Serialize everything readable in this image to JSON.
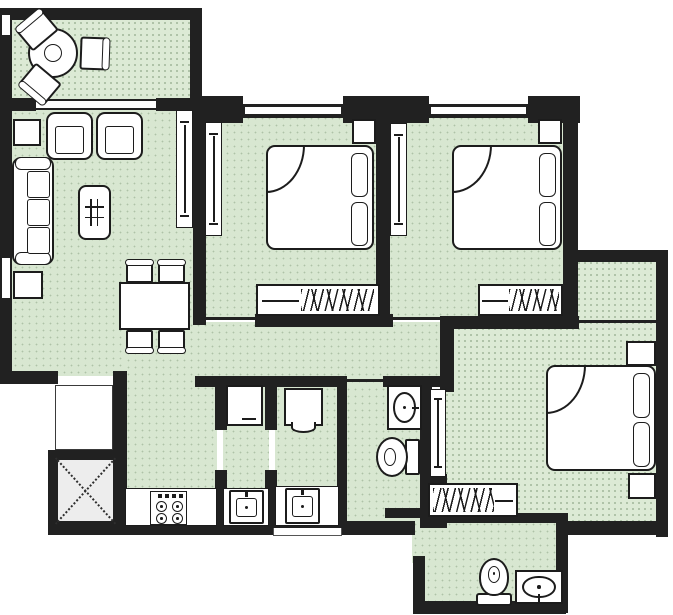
{
  "meta": {
    "canvas": {
      "w": 673,
      "h": 615
    }
  },
  "palette": {
    "wall": "#212121",
    "floor_green": "#d8e7d1",
    "balcony_green": "#dcead5",
    "shaft_gray": "#ededed",
    "furniture_fill": "#ffffff",
    "furniture_stroke": "#1c1c1c"
  },
  "rooms": [
    {
      "name": "balcony-floor",
      "kind": "dotted",
      "x": 12,
      "y": 20,
      "w": 178,
      "h": 80
    },
    {
      "name": "living-dining-floor",
      "kind": "plain",
      "x": 12,
      "y": 110,
      "w": 181,
      "h": 266
    },
    {
      "name": "hallway-floor",
      "kind": "plain",
      "x": 125,
      "y": 322,
      "w": 318,
      "h": 64
    },
    {
      "name": "kitchen-floor",
      "kind": "plain",
      "x": 125,
      "y": 378,
      "w": 92,
      "h": 148
    },
    {
      "name": "utility-a-floor",
      "kind": "plain",
      "x": 223,
      "y": 386,
      "w": 46,
      "h": 140
    },
    {
      "name": "utility-b-floor",
      "kind": "plain",
      "x": 275,
      "y": 386,
      "w": 64,
      "h": 140
    },
    {
      "name": "corridor-floor",
      "kind": "plain",
      "x": 345,
      "y": 386,
      "w": 87,
      "h": 146
    },
    {
      "name": "common-bathroom-floor",
      "kind": "plain",
      "x": 385,
      "y": 386,
      "w": 47,
      "h": 128
    },
    {
      "name": "bedroom-1-floor",
      "kind": "plain",
      "x": 203,
      "y": 108,
      "w": 180,
      "h": 212
    },
    {
      "name": "bedroom-2-floor",
      "kind": "plain",
      "x": 388,
      "y": 108,
      "w": 182,
      "h": 212
    },
    {
      "name": "bedroom-3-floor",
      "kind": "dotted",
      "x": 444,
      "y": 326,
      "w": 216,
      "h": 200
    },
    {
      "name": "bedroom-3-ext-floor",
      "kind": "dotted",
      "x": 576,
      "y": 260,
      "w": 84,
      "h": 70
    },
    {
      "name": "attached-bathroom-floor",
      "kind": "plain",
      "x": 425,
      "y": 521,
      "w": 139,
      "h": 86
    },
    {
      "name": "bath-door-passage-floor",
      "kind": "plain",
      "x": 412,
      "y": 521,
      "w": 20,
      "h": 42
    },
    {
      "name": "shaft-floor",
      "kind": "shaft",
      "x": 56,
      "y": 458,
      "w": 60,
      "h": 66
    }
  ],
  "walls": [
    {
      "x": 2,
      "y": 8,
      "w": 200,
      "h": 12
    },
    {
      "x": 0,
      "y": 8,
      "w": 12,
      "h": 7
    },
    {
      "x": 0,
      "y": 35,
      "w": 12,
      "h": 75
    },
    {
      "x": 190,
      "y": 8,
      "w": 12,
      "h": 100
    },
    {
      "x": 12,
      "y": 98,
      "w": 24,
      "h": 13
    },
    {
      "x": 156,
      "y": 98,
      "w": 46,
      "h": 13
    },
    {
      "x": 0,
      "y": 110,
      "w": 12,
      "h": 148
    },
    {
      "x": 0,
      "y": 298,
      "w": 12,
      "h": 80
    },
    {
      "x": 0,
      "y": 371,
      "w": 58,
      "h": 13
    },
    {
      "x": 113,
      "y": 371,
      "w": 14,
      "h": 160
    },
    {
      "x": 48,
      "y": 450,
      "w": 68,
      "h": 10
    },
    {
      "x": 48,
      "y": 450,
      "w": 10,
      "h": 82
    },
    {
      "x": 48,
      "y": 521,
      "w": 225,
      "h": 14
    },
    {
      "x": 342,
      "y": 521,
      "w": 73,
      "h": 14
    },
    {
      "x": 273,
      "y": 521,
      "w": 69,
      "h": 7
    },
    {
      "x": 193,
      "y": 98,
      "w": 13,
      "h": 227
    },
    {
      "x": 195,
      "y": 104,
      "w": 385,
      "h": 14
    },
    {
      "x": 195,
      "y": 96,
      "w": 48,
      "h": 27
    },
    {
      "x": 343,
      "y": 96,
      "w": 86,
      "h": 27
    },
    {
      "x": 528,
      "y": 96,
      "w": 52,
      "h": 27
    },
    {
      "x": 376,
      "y": 98,
      "w": 14,
      "h": 220
    },
    {
      "x": 563,
      "y": 98,
      "w": 15,
      "h": 225
    },
    {
      "x": 565,
      "y": 258,
      "w": 13,
      "h": 66
    },
    {
      "x": 565,
      "y": 250,
      "w": 103,
      "h": 12
    },
    {
      "x": 656,
      "y": 250,
      "w": 12,
      "h": 287
    },
    {
      "x": 255,
      "y": 314,
      "w": 124,
      "h": 13
    },
    {
      "x": 376,
      "y": 314,
      "w": 17,
      "h": 13
    },
    {
      "x": 443,
      "y": 316,
      "w": 136,
      "h": 13
    },
    {
      "x": 440,
      "y": 316,
      "w": 14,
      "h": 76
    },
    {
      "x": 195,
      "y": 376,
      "w": 150,
      "h": 11
    },
    {
      "x": 383,
      "y": 376,
      "w": 60,
      "h": 11
    },
    {
      "x": 215,
      "y": 376,
      "w": 12,
      "h": 54
    },
    {
      "x": 215,
      "y": 470,
      "w": 12,
      "h": 58
    },
    {
      "x": 265,
      "y": 376,
      "w": 12,
      "h": 54
    },
    {
      "x": 265,
      "y": 470,
      "w": 12,
      "h": 58
    },
    {
      "x": 337,
      "y": 376,
      "w": 10,
      "h": 152
    },
    {
      "x": 420,
      "y": 387,
      "w": 12,
      "h": 141
    },
    {
      "x": 432,
      "y": 474,
      "w": 15,
      "h": 54
    },
    {
      "x": 385,
      "y": 508,
      "w": 47,
      "h": 10
    },
    {
      "x": 427,
      "y": 513,
      "w": 133,
      "h": 10
    },
    {
      "x": 556,
      "y": 513,
      "w": 12,
      "h": 100
    },
    {
      "x": 556,
      "y": 521,
      "w": 112,
      "h": 14
    },
    {
      "x": 413,
      "y": 601,
      "w": 153,
      "h": 13
    },
    {
      "x": 413,
      "y": 556,
      "w": 12,
      "h": 50
    }
  ],
  "windows": [
    {
      "name": "balcony-side-window",
      "dir": "v",
      "x": 0,
      "y": 15,
      "w": 12,
      "h": 20
    },
    {
      "name": "balcony-living-window",
      "dir": "h",
      "x": 36,
      "y": 99,
      "w": 120,
      "h": 11
    },
    {
      "name": "living-room-window",
      "dir": "v",
      "x": 0,
      "y": 258,
      "w": 12,
      "h": 40
    },
    {
      "name": "bedroom-1-window",
      "dir": "h",
      "x": 245,
      "y": 105,
      "w": 96,
      "h": 11
    },
    {
      "name": "bedroom-2-window",
      "dir": "h",
      "x": 431,
      "y": 105,
      "w": 95,
      "h": 11
    }
  ],
  "openings": [
    {
      "name": "bedroom-1-door-opening",
      "x": 203,
      "y": 317,
      "w": 52,
      "h": 3
    },
    {
      "name": "bedroom-2-door-opening",
      "x": 393,
      "y": 317,
      "w": 50,
      "h": 3
    },
    {
      "name": "corridor-opening",
      "x": 345,
      "y": 379,
      "w": 38,
      "h": 3
    },
    {
      "name": "bedroom-3-ext-sill",
      "x": 578,
      "y": 320,
      "w": 78,
      "h": 3
    }
  ],
  "furniture": [
    {
      "type": "round-table",
      "name": "balcony-round-table",
      "x": 28,
      "y": 28,
      "w": 50,
      "h": 50
    },
    {
      "type": "chair-rot",
      "name": "balcony-chair-1",
      "x": 20,
      "y": 16,
      "w": 34,
      "h": 28,
      "rot": -40,
      "back": "top"
    },
    {
      "type": "chair-rot",
      "name": "balcony-chair-2",
      "x": 80,
      "y": 37,
      "w": 28,
      "h": 33,
      "rot": 2,
      "back": "right"
    },
    {
      "type": "chair-rot",
      "name": "balcony-chair-3",
      "x": 23,
      "y": 70,
      "w": 34,
      "h": 28,
      "rot": 40,
      "back": "bottom"
    },
    {
      "type": "side-table",
      "name": "side-table-1",
      "x": 13,
      "y": 119,
      "w": 28,
      "h": 27
    },
    {
      "type": "armchair",
      "name": "armchair-1",
      "x": 46,
      "y": 112,
      "w": 47,
      "h": 48
    },
    {
      "type": "armchair",
      "name": "armchair-2",
      "x": 96,
      "y": 112,
      "w": 47,
      "h": 48
    },
    {
      "type": "sofa",
      "name": "sofa",
      "x": 12,
      "y": 157,
      "w": 42,
      "h": 108
    },
    {
      "type": "side-table",
      "name": "side-table-2",
      "x": 13,
      "y": 271,
      "w": 30,
      "h": 28
    },
    {
      "type": "coffee-table",
      "name": "coffee-table",
      "x": 78,
      "y": 185,
      "w": 33,
      "h": 55
    },
    {
      "type": "dining-table",
      "name": "dining-table",
      "x": 119,
      "y": 282,
      "w": 71,
      "h": 48
    },
    {
      "type": "dining-chair",
      "name": "dining-chair-1",
      "x": 126,
      "y": 263,
      "w": 27,
      "h": 20,
      "back": "top"
    },
    {
      "type": "dining-chair",
      "name": "dining-chair-2",
      "x": 158,
      "y": 263,
      "w": 27,
      "h": 20,
      "back": "top"
    },
    {
      "type": "dining-chair",
      "name": "dining-chair-3",
      "x": 126,
      "y": 330,
      "w": 27,
      "h": 20,
      "back": "bottom"
    },
    {
      "type": "dining-chair",
      "name": "dining-chair-4",
      "x": 158,
      "y": 330,
      "w": 27,
      "h": 20,
      "back": "bottom"
    },
    {
      "type": "door-panel",
      "name": "living-wall-cabinet",
      "x": 176,
      "y": 110,
      "w": 17,
      "h": 118
    },
    {
      "type": "door-panel",
      "name": "bedroom-1-sliding-door",
      "x": 205,
      "y": 122,
      "w": 17,
      "h": 114
    },
    {
      "type": "bed",
      "name": "bed-1",
      "x": 266,
      "y": 145,
      "w": 108,
      "h": 105
    },
    {
      "type": "nightstand",
      "name": "nightstand-1",
      "x": 352,
      "y": 119,
      "w": 24,
      "h": 25
    },
    {
      "type": "wardrobe",
      "name": "wardrobe-1",
      "x": 256,
      "y": 284,
      "w": 124,
      "h": 32,
      "hatch": "right"
    },
    {
      "type": "door-panel",
      "name": "bedroom-2-sliding-door",
      "x": 390,
      "y": 123,
      "w": 17,
      "h": 113
    },
    {
      "type": "bed",
      "name": "bed-2",
      "x": 452,
      "y": 145,
      "w": 110,
      "h": 105
    },
    {
      "type": "nightstand",
      "name": "nightstand-2",
      "x": 538,
      "y": 119,
      "w": 24,
      "h": 25
    },
    {
      "type": "wardrobe",
      "name": "wardrobe-2",
      "x": 478,
      "y": 284,
      "w": 85,
      "h": 32,
      "hatch": "right"
    },
    {
      "type": "door-panel",
      "name": "bedroom-3-sliding-door",
      "x": 430,
      "y": 389,
      "w": 16,
      "h": 88
    },
    {
      "type": "bed",
      "name": "bed-3",
      "x": 546,
      "y": 365,
      "w": 110,
      "h": 106
    },
    {
      "type": "nightstand",
      "name": "nightstand-3a",
      "x": 626,
      "y": 341,
      "w": 30,
      "h": 25
    },
    {
      "type": "nightstand",
      "name": "nightstand-3b",
      "x": 628,
      "y": 473,
      "w": 28,
      "h": 26
    },
    {
      "type": "wardrobe",
      "name": "wardrobe-3",
      "x": 428,
      "y": 483,
      "w": 90,
      "h": 34,
      "hatch": "left"
    },
    {
      "type": "counter",
      "name": "kitchen-counter",
      "x": 125,
      "y": 488,
      "w": 92,
      "h": 38
    },
    {
      "type": "counter",
      "name": "utility-a-counter",
      "x": 223,
      "y": 488,
      "w": 46,
      "h": 38
    },
    {
      "type": "counter",
      "name": "utility-b-counter",
      "x": 275,
      "y": 486,
      "w": 64,
      "h": 40
    },
    {
      "type": "stove",
      "name": "gas-stove",
      "x": 150,
      "y": 491,
      "w": 37,
      "h": 34
    },
    {
      "type": "sink-square",
      "name": "utility-a-sink",
      "x": 229,
      "y": 490,
      "w": 35,
      "h": 34
    },
    {
      "type": "sink-square",
      "name": "utility-b-sink",
      "x": 285,
      "y": 488,
      "w": 35,
      "h": 36
    },
    {
      "type": "wall-box-a",
      "name": "washing-machine",
      "x": 226,
      "y": 385,
      "w": 37,
      "h": 41
    },
    {
      "type": "wall-box-b",
      "name": "water-heater",
      "x": 284,
      "y": 388,
      "w": 39,
      "h": 38
    },
    {
      "type": "basin-box",
      "name": "common-bath-washbasin",
      "x": 387,
      "y": 385,
      "w": 35,
      "h": 45,
      "tap": "right"
    },
    {
      "type": "wc",
      "name": "common-bath-toilet",
      "x": 376,
      "y": 437,
      "w": 44,
      "h": 40,
      "dir": "left"
    },
    {
      "type": "wc",
      "name": "attached-bath-toilet",
      "x": 476,
      "y": 558,
      "w": 36,
      "h": 48,
      "dir": "up"
    },
    {
      "type": "basin-box",
      "name": "attached-bath-washbasin",
      "x": 515,
      "y": 570,
      "w": 48,
      "h": 34,
      "tap": "bottom"
    },
    {
      "type": "shaft-x",
      "name": "shaft-duct-mark",
      "x": 56,
      "y": 458,
      "w": 60,
      "h": 66
    },
    {
      "type": "duct",
      "name": "service-duct",
      "x": 55,
      "y": 385,
      "w": 58,
      "h": 65
    },
    {
      "type": "step",
      "name": "entrance-step",
      "x": 273,
      "y": 528,
      "w": 69,
      "h": 8
    }
  ]
}
